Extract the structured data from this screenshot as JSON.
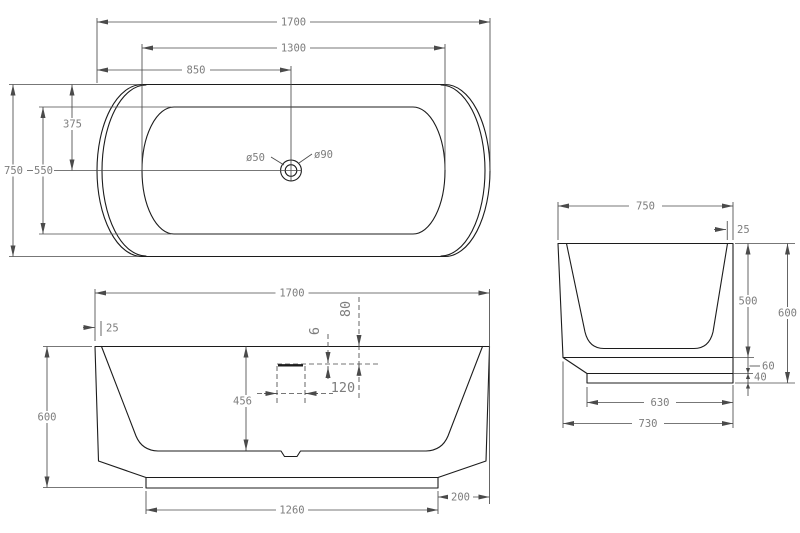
{
  "colors": {
    "background": "#ffffff",
    "outline": "#1c1c1c",
    "dimension_lines": "#4a4a4a",
    "dimension_text": "#7d7d7d"
  },
  "views": {
    "top": {
      "label": "plan-view",
      "dims": {
        "overall_length": "1700",
        "inner_length": "1300",
        "drain_from_left": "850",
        "overall_width": "750",
        "inner_width": "550",
        "drain_from_side": "375",
        "drain_small_diameter": "ø50",
        "drain_large_diameter": "ø90"
      }
    },
    "front": {
      "label": "front-elevation",
      "dims": {
        "overall_length": "1700",
        "rim_thickness": "25",
        "overall_height": "600",
        "rim_to_basin_bottom": "456",
        "overflow_width": "120",
        "overflow_drop": "80",
        "overflow_offset": "6",
        "base_length": "1260",
        "base_inset": "200"
      }
    },
    "side": {
      "label": "side-elevation",
      "dims": {
        "overall_width": "750",
        "rim_thickness": "25",
        "inner_depth": "500",
        "overall_height": "600",
        "shell_gap": "60",
        "base_height": "40",
        "base_width": "630",
        "bottom_width": "730"
      }
    }
  }
}
